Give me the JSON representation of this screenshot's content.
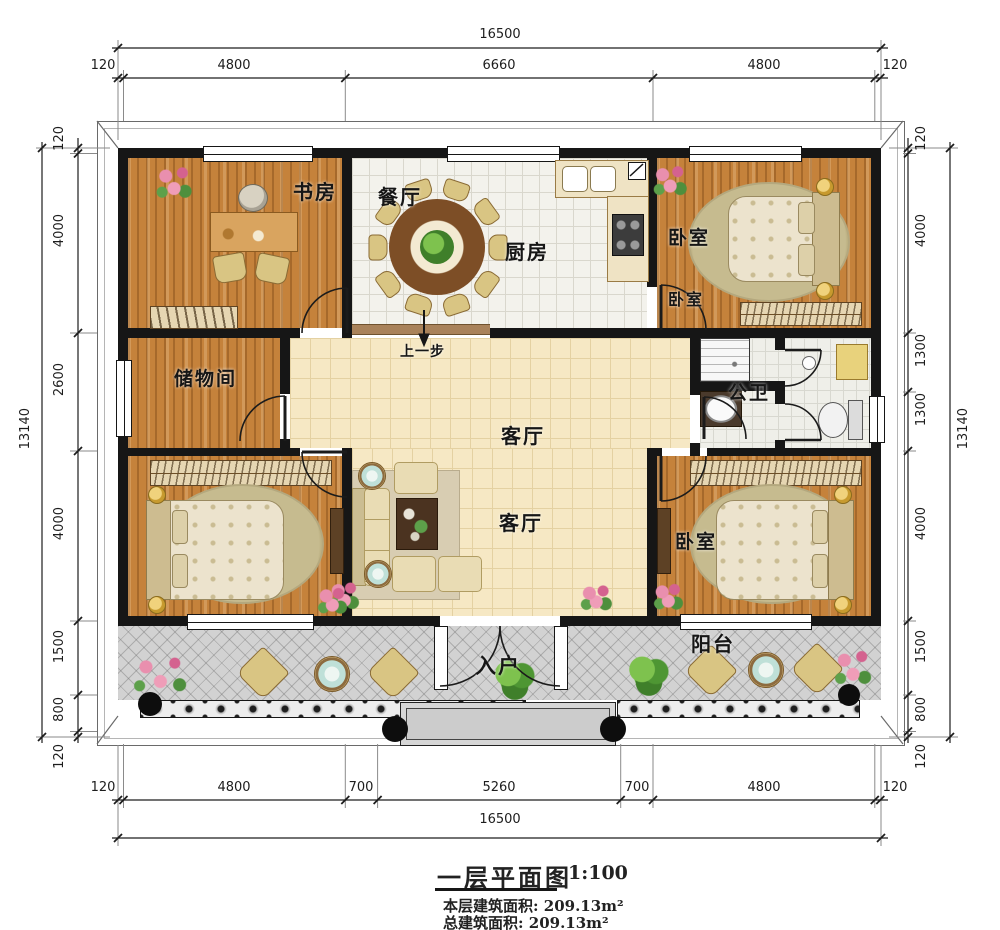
{
  "title_block": {
    "name": "一层平面图",
    "scale": "1:100",
    "area1": "本层建筑面积: 209.13m²",
    "area2": "总建筑面积: 209.13m²"
  },
  "rooms": {
    "study": "书房",
    "dining": "餐厅",
    "kitchen": "厨房",
    "bedroom_tr": "卧室",
    "bedroom_tr2": "卧室",
    "storage": "储物间",
    "bathroom": "公卫",
    "living_a": "客厅",
    "living_b": "客厅",
    "bedroom_br": "卧室",
    "balcony": "阳台",
    "entry": "入户",
    "stair_note": "上一步"
  },
  "dims": {
    "top_total": "16500",
    "top": [
      "120",
      "4800",
      "6660",
      "4800",
      "120"
    ],
    "bottom": [
      "120",
      "4800",
      "700",
      "5260",
      "700",
      "4800",
      "120"
    ],
    "bottom_total": "16500",
    "left_total": "13140",
    "left": [
      "120",
      "4000",
      "2600",
      "4000",
      "1500",
      "800",
      "120"
    ],
    "right": [
      "120",
      "4000",
      "1300",
      "1300",
      "4000",
      "1500",
      "800",
      "120"
    ],
    "right_total": "13140"
  }
}
